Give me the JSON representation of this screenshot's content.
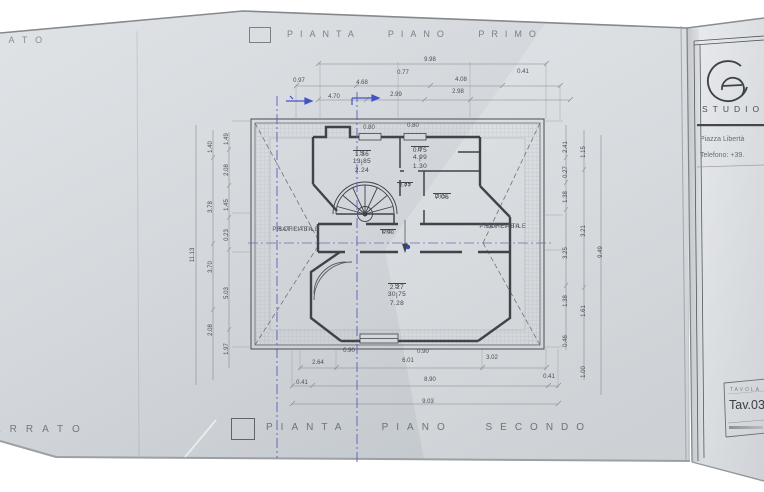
{
  "palette": {
    "paper": "#d4d8dc",
    "ink": "#3f434a",
    "dim_ink": "#4a4e55",
    "blue_pen": "#4353c2",
    "title_gray": "#7b8087"
  },
  "sheet": {
    "top_left_fragment": "RATO",
    "bottom_left_fragment": "ERRATO",
    "title_top": "PIANTA PIANO PRIMO",
    "title_bottom": "PIANTA PIANO SECONDO"
  },
  "titleblock": {
    "studio": "STUDIO",
    "address": "Piazza Libertà",
    "phone": "Telefono: +39.",
    "tavola_label": "TAVOLA",
    "tav_number": "Tav.03"
  },
  "plan": {
    "rooms": [
      {
        "top": "S   13.85",
        "bot": "1.36 | 2.24",
        "x": 362,
        "y": 150,
        "frac": true
      },
      {
        "top": "B   4.99",
        "bot": "0.75 | 1.30",
        "x": 420,
        "y": 146,
        "frac": true
      },
      {
        "top": "9.85",
        "bot": "1.77",
        "x": 405,
        "y": 182,
        "frac": true,
        "small": true
      },
      {
        "top": "DIS.",
        "bot": "7.06",
        "x": 442,
        "y": 193,
        "frac": true
      },
      {
        "top": "DIS.",
        "bot": "6.90",
        "x": 388,
        "y": 229,
        "frac": true,
        "small": true
      },
      {
        "top": "S   30.75",
        "bot": "2.27 | 7.28",
        "x": 397,
        "y": 283,
        "frac": true
      },
      {
        "top": "SOFFITTA",
        "bot": "PRATICABILE",
        "x": 296,
        "y": 227,
        "soff": true
      },
      {
        "top": "SOFFITTA",
        "bot": "PRATICABILE",
        "x": 503,
        "y": 224,
        "soff": true
      }
    ],
    "dims": [
      {
        "t": "9.98",
        "x": 430,
        "y": 60
      },
      {
        "t": "0.77",
        "x": 403,
        "y": 73
      },
      {
        "t": "0.41",
        "x": 523,
        "y": 72
      },
      {
        "t": "0.97",
        "x": 299,
        "y": 81
      },
      {
        "t": "4.68",
        "x": 362,
        "y": 83
      },
      {
        "t": "4.08",
        "x": 461,
        "y": 80
      },
      {
        "t": "4.70",
        "x": 334,
        "y": 97
      },
      {
        "t": "2.99",
        "x": 396,
        "y": 95
      },
      {
        "t": "2.98",
        "x": 458,
        "y": 92
      },
      {
        "t": "0.80",
        "x": 369,
        "y": 128
      },
      {
        "t": "0.80",
        "x": 413,
        "y": 126
      },
      {
        "t": "11.13",
        "x": 193,
        "y": 255,
        "r": -90
      },
      {
        "t": "1.40",
        "x": 211,
        "y": 147,
        "r": -90
      },
      {
        "t": "3.78",
        "x": 211,
        "y": 207,
        "r": -90
      },
      {
        "t": "3.70",
        "x": 211,
        "y": 267,
        "r": -90
      },
      {
        "t": "2.08",
        "x": 211,
        "y": 330,
        "r": -90
      },
      {
        "t": "1.49",
        "x": 227,
        "y": 139,
        "r": -90
      },
      {
        "t": "2.08",
        "x": 227,
        "y": 170,
        "r": -90
      },
      {
        "t": "1.45",
        "x": 227,
        "y": 205,
        "r": -90
      },
      {
        "t": "0.23",
        "x": 227,
        "y": 235,
        "r": -90
      },
      {
        "t": "5.03",
        "x": 227,
        "y": 293,
        "r": -90
      },
      {
        "t": "1.97",
        "x": 227,
        "y": 349,
        "r": -90
      },
      {
        "t": "2.41",
        "x": 566,
        "y": 147,
        "r": -90
      },
      {
        "t": "0.27",
        "x": 566,
        "y": 172,
        "r": -90
      },
      {
        "t": "1.38",
        "x": 566,
        "y": 197,
        "r": -90
      },
      {
        "t": "3.25",
        "x": 566,
        "y": 253,
        "r": -90
      },
      {
        "t": "1.38",
        "x": 566,
        "y": 301,
        "r": -90
      },
      {
        "t": "0.46",
        "x": 566,
        "y": 341,
        "r": -90
      },
      {
        "t": "1.15",
        "x": 584,
        "y": 152,
        "r": -90
      },
      {
        "t": "3.21",
        "x": 584,
        "y": 231,
        "r": -90
      },
      {
        "t": "1.61",
        "x": 584,
        "y": 311,
        "r": -90
      },
      {
        "t": "1.00",
        "x": 584,
        "y": 372,
        "r": -90
      },
      {
        "t": "9.49",
        "x": 601,
        "y": 252,
        "r": -90
      },
      {
        "t": "2.64",
        "x": 318,
        "y": 363
      },
      {
        "t": "6.01",
        "x": 408,
        "y": 361
      },
      {
        "t": "3.02",
        "x": 492,
        "y": 358
      },
      {
        "t": "0.41",
        "x": 302,
        "y": 383
      },
      {
        "t": "8.90",
        "x": 430,
        "y": 380
      },
      {
        "t": "0.41",
        "x": 549,
        "y": 377
      },
      {
        "t": "9.03",
        "x": 428,
        "y": 402
      },
      {
        "t": "0.90",
        "x": 349,
        "y": 351
      },
      {
        "t": "0.90",
        "x": 423,
        "y": 352
      }
    ]
  }
}
